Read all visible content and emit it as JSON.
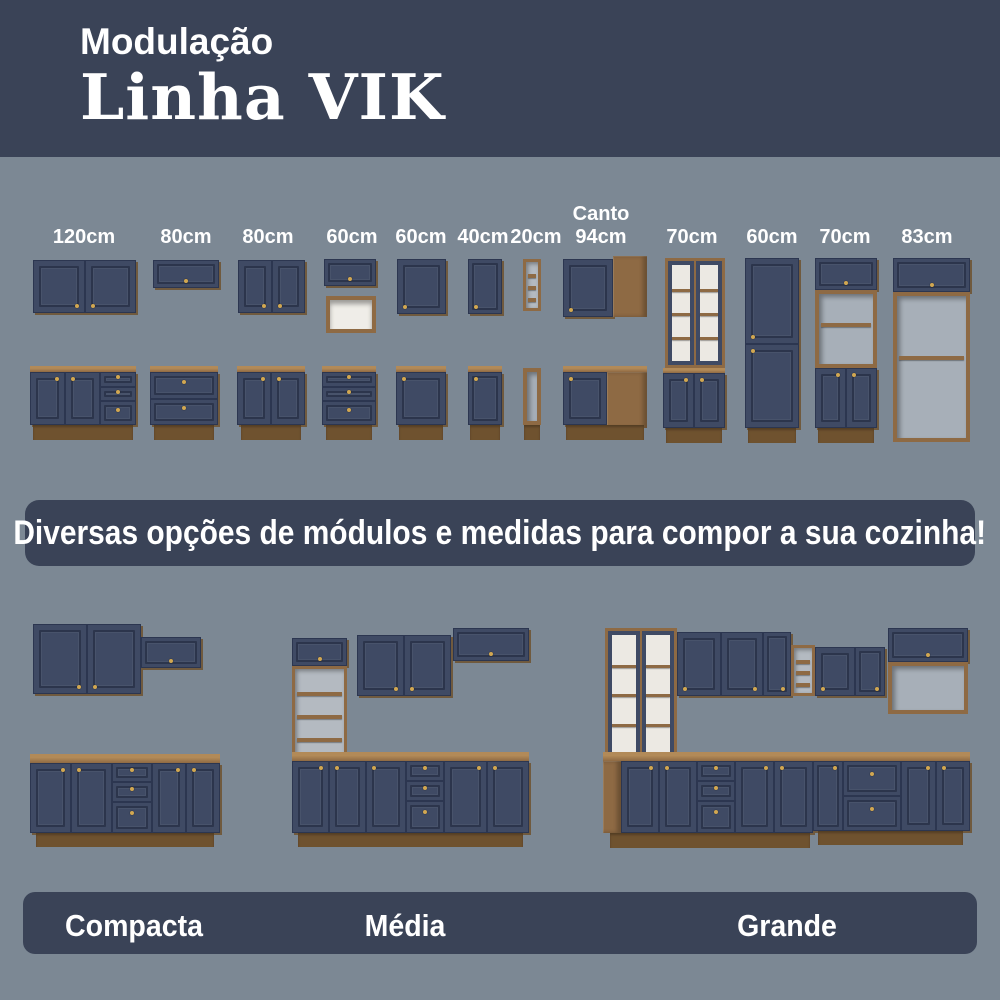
{
  "palette": {
    "background": "#7C8894",
    "panel_navy": "#3A4357",
    "cabinet_navy": "#3F4A64",
    "cabinet_navy_edge": "#2C3650",
    "wood": "#8E6A44",
    "wood_dark": "#6F522F",
    "knob_gold": "#D2A852",
    "text_white": "#FFFFFF"
  },
  "header": {
    "kicker": "Modulação",
    "title": "Linha VIK"
  },
  "banner": {
    "text": "Diversas opções de módulos e medidas para compor a sua cozinha!"
  },
  "modules": {
    "items": [
      {
        "name": "module-120cm",
        "label": "120cm",
        "lx": 84,
        "pieces": [
          {
            "t": "doors2",
            "x": 33,
            "y": 260,
            "w": 103,
            "h": 53,
            "k": "b"
          },
          {
            "t": "counter",
            "x": 30,
            "y": 366,
            "w": 106,
            "h": 6
          },
          {
            "t": "doors2",
            "x": 30,
            "y": 372,
            "w": 70,
            "h": 53,
            "k": "t"
          },
          {
            "t": "drawers3",
            "x": 100,
            "y": 372,
            "w": 36,
            "h": 53
          },
          {
            "t": "plinth",
            "x": 33,
            "y": 425,
            "w": 100,
            "h": 15
          }
        ]
      },
      {
        "name": "module-80cm-a",
        "label": "80cm",
        "lx": 186,
        "pieces": [
          {
            "t": "hdoor",
            "x": 153,
            "y": 260,
            "w": 66,
            "h": 28
          },
          {
            "t": "counter",
            "x": 150,
            "y": 366,
            "w": 68,
            "h": 6
          },
          {
            "t": "drawers2",
            "x": 150,
            "y": 372,
            "w": 68,
            "h": 53
          },
          {
            "t": "plinth",
            "x": 154,
            "y": 425,
            "w": 60,
            "h": 15
          }
        ]
      },
      {
        "name": "module-80cm-b",
        "label": "80cm",
        "lx": 268,
        "pieces": [
          {
            "t": "doors2",
            "x": 238,
            "y": 260,
            "w": 67,
            "h": 53,
            "k": "b"
          },
          {
            "t": "counter",
            "x": 237,
            "y": 366,
            "w": 68,
            "h": 6
          },
          {
            "t": "doors2",
            "x": 237,
            "y": 372,
            "w": 68,
            "h": 53,
            "k": "t"
          },
          {
            "t": "plinth",
            "x": 241,
            "y": 425,
            "w": 60,
            "h": 15
          }
        ]
      },
      {
        "name": "module-60cm-a",
        "label": "60cm",
        "lx": 352,
        "pieces": [
          {
            "t": "hdoor",
            "x": 324,
            "y": 259,
            "w": 52,
            "h": 27
          },
          {
            "t": "niche",
            "x": 326,
            "y": 296,
            "w": 50,
            "h": 37
          },
          {
            "t": "counter",
            "x": 322,
            "y": 366,
            "w": 54,
            "h": 6
          },
          {
            "t": "drawers3",
            "x": 322,
            "y": 372,
            "w": 54,
            "h": 53
          },
          {
            "t": "plinth",
            "x": 326,
            "y": 425,
            "w": 46,
            "h": 15
          }
        ]
      },
      {
        "name": "module-60cm-b",
        "label": "60cm",
        "lx": 421,
        "pieces": [
          {
            "t": "door",
            "x": 397,
            "y": 259,
            "w": 49,
            "h": 55,
            "k": "bl"
          },
          {
            "t": "counter",
            "x": 396,
            "y": 366,
            "w": 50,
            "h": 6
          },
          {
            "t": "door",
            "x": 396,
            "y": 372,
            "w": 50,
            "h": 53,
            "k": "tl"
          },
          {
            "t": "plinth",
            "x": 399,
            "y": 425,
            "w": 44,
            "h": 15
          }
        ]
      },
      {
        "name": "module-40cm",
        "label": "40cm",
        "lx": 483,
        "pieces": [
          {
            "t": "door",
            "x": 468,
            "y": 259,
            "w": 34,
            "h": 55,
            "k": "bl"
          },
          {
            "t": "counter",
            "x": 468,
            "y": 366,
            "w": 34,
            "h": 6
          },
          {
            "t": "door",
            "x": 468,
            "y": 372,
            "w": 34,
            "h": 53,
            "k": "tl"
          },
          {
            "t": "plinth",
            "x": 470,
            "y": 425,
            "w": 30,
            "h": 15
          }
        ]
      },
      {
        "name": "module-20cm",
        "label": "20cm",
        "lx": 536,
        "pieces": [
          {
            "t": "shelves",
            "x": 523,
            "y": 259,
            "w": 18,
            "h": 52
          },
          {
            "t": "open",
            "x": 523,
            "y": 368,
            "w": 18,
            "h": 57
          },
          {
            "t": "plinth",
            "x": 524,
            "y": 425,
            "w": 16,
            "h": 15
          }
        ]
      },
      {
        "name": "module-canto-94cm",
        "label": "Canto\n94cm",
        "lx": 601,
        "pieces": [
          {
            "t": "door",
            "x": 563,
            "y": 259,
            "w": 50,
            "h": 58,
            "k": "bl"
          },
          {
            "t": "wood",
            "x": 613,
            "y": 256,
            "w": 34,
            "h": 61
          },
          {
            "t": "counter",
            "x": 563,
            "y": 366,
            "w": 84,
            "h": 6
          },
          {
            "t": "door",
            "x": 563,
            "y": 372,
            "w": 44,
            "h": 53,
            "k": "tl"
          },
          {
            "t": "wood",
            "x": 607,
            "y": 372,
            "w": 40,
            "h": 56
          },
          {
            "t": "plinth",
            "x": 566,
            "y": 425,
            "w": 78,
            "h": 15
          }
        ]
      },
      {
        "name": "module-70cm-cristaleira",
        "label": "70cm",
        "lx": 692,
        "pieces": [
          {
            "t": "glass2",
            "x": 665,
            "y": 258,
            "w": 60,
            "h": 110
          },
          {
            "t": "counter",
            "x": 663,
            "y": 368,
            "w": 62,
            "h": 5
          },
          {
            "t": "doors2",
            "x": 663,
            "y": 373,
            "w": 62,
            "h": 55,
            "k": "t"
          },
          {
            "t": "plinth",
            "x": 666,
            "y": 428,
            "w": 56,
            "h": 15
          }
        ]
      },
      {
        "name": "module-60cm-paneleiro",
        "label": "60cm",
        "lx": 772,
        "pieces": [
          {
            "t": "door",
            "x": 745,
            "y": 258,
            "w": 54,
            "h": 86,
            "k": "bl"
          },
          {
            "t": "door",
            "x": 745,
            "y": 344,
            "w": 54,
            "h": 84,
            "k": "tl"
          },
          {
            "t": "plinth",
            "x": 748,
            "y": 428,
            "w": 48,
            "h": 15
          }
        ]
      },
      {
        "name": "module-70cm-torre",
        "label": "70cm",
        "lx": 845,
        "pieces": [
          {
            "t": "hdoor",
            "x": 815,
            "y": 258,
            "w": 62,
            "h": 32
          },
          {
            "t": "open",
            "x": 815,
            "y": 290,
            "w": 62,
            "h": 78
          },
          {
            "t": "doors2",
            "x": 815,
            "y": 368,
            "w": 62,
            "h": 60,
            "k": "t"
          },
          {
            "t": "plinth",
            "x": 818,
            "y": 428,
            "w": 56,
            "h": 15
          }
        ]
      },
      {
        "name": "module-83cm",
        "label": "83cm",
        "lx": 927,
        "pieces": [
          {
            "t": "hdoor",
            "x": 893,
            "y": 258,
            "w": 77,
            "h": 34
          },
          {
            "t": "open",
            "x": 893,
            "y": 292,
            "w": 77,
            "h": 150
          }
        ]
      }
    ]
  },
  "kitchens": {
    "items": [
      {
        "name": "compacta",
        "label": "Compacta",
        "pieces": [
          {
            "t": "doors2",
            "x": 33,
            "y": 624,
            "w": 108,
            "h": 70,
            "k": "b"
          },
          {
            "t": "hdoor",
            "x": 141,
            "y": 637,
            "w": 60,
            "h": 31
          },
          {
            "t": "counter",
            "x": 30,
            "y": 754,
            "w": 190,
            "h": 9
          },
          {
            "t": "doors2",
            "x": 30,
            "y": 763,
            "w": 82,
            "h": 70,
            "k": "t"
          },
          {
            "t": "drawers3",
            "x": 112,
            "y": 763,
            "w": 40,
            "h": 70
          },
          {
            "t": "doors2",
            "x": 152,
            "y": 763,
            "w": 68,
            "h": 70,
            "k": "t"
          },
          {
            "t": "plinth",
            "x": 36,
            "y": 833,
            "w": 178,
            "h": 14
          }
        ]
      },
      {
        "name": "media",
        "label": "Média",
        "pieces": [
          {
            "t": "hdoor",
            "x": 292,
            "y": 638,
            "w": 55,
            "h": 28
          },
          {
            "t": "shelves",
            "x": 292,
            "y": 666,
            "w": 55,
            "h": 94
          },
          {
            "t": "doors2",
            "x": 357,
            "y": 635,
            "w": 94,
            "h": 61,
            "k": "b"
          },
          {
            "t": "hdoor",
            "x": 453,
            "y": 628,
            "w": 76,
            "h": 33
          },
          {
            "t": "counter",
            "x": 292,
            "y": 752,
            "w": 237,
            "h": 9
          },
          {
            "t": "doors2",
            "x": 292,
            "y": 761,
            "w": 74,
            "h": 72,
            "k": "t"
          },
          {
            "t": "door",
            "x": 366,
            "y": 761,
            "w": 40,
            "h": 72,
            "k": "tl"
          },
          {
            "t": "drawers3",
            "x": 406,
            "y": 761,
            "w": 38,
            "h": 72
          },
          {
            "t": "doors2",
            "x": 444,
            "y": 761,
            "w": 85,
            "h": 72,
            "k": "t"
          },
          {
            "t": "plinth",
            "x": 298,
            "y": 833,
            "w": 225,
            "h": 14
          }
        ]
      },
      {
        "name": "grande",
        "label": "Grande",
        "pieces": [
          {
            "t": "glass2",
            "x": 605,
            "y": 628,
            "w": 72,
            "h": 132
          },
          {
            "t": "door",
            "x": 677,
            "y": 632,
            "w": 44,
            "h": 64,
            "k": "bl"
          },
          {
            "t": "door",
            "x": 721,
            "y": 632,
            "w": 42,
            "h": 64,
            "k": "br"
          },
          {
            "t": "door",
            "x": 763,
            "y": 632,
            "w": 28,
            "h": 64,
            "k": "br"
          },
          {
            "t": "shelves",
            "x": 791,
            "y": 645,
            "w": 24,
            "h": 51
          },
          {
            "t": "door",
            "x": 815,
            "y": 647,
            "w": 40,
            "h": 49,
            "k": "bl"
          },
          {
            "t": "door",
            "x": 855,
            "y": 647,
            "w": 30,
            "h": 49,
            "k": "br"
          },
          {
            "t": "hdoor",
            "x": 888,
            "y": 628,
            "w": 80,
            "h": 34
          },
          {
            "t": "open",
            "x": 888,
            "y": 662,
            "w": 80,
            "h": 52
          },
          {
            "t": "counter",
            "x": 603,
            "y": 752,
            "w": 212,
            "h": 9
          },
          {
            "t": "counter",
            "x": 813,
            "y": 752,
            "w": 157,
            "h": 9
          },
          {
            "t": "wood",
            "x": 603,
            "y": 761,
            "w": 18,
            "h": 72
          },
          {
            "t": "doors2",
            "x": 621,
            "y": 761,
            "w": 76,
            "h": 72,
            "k": "t"
          },
          {
            "t": "drawers3",
            "x": 697,
            "y": 761,
            "w": 38,
            "h": 72
          },
          {
            "t": "doors2",
            "x": 735,
            "y": 761,
            "w": 78,
            "h": 72,
            "k": "t"
          },
          {
            "t": "door",
            "x": 813,
            "y": 761,
            "w": 30,
            "h": 70,
            "k": "tr"
          },
          {
            "t": "drawers2",
            "x": 843,
            "y": 761,
            "w": 58,
            "h": 70
          },
          {
            "t": "doors2",
            "x": 901,
            "y": 761,
            "w": 69,
            "h": 70,
            "k": "t"
          },
          {
            "t": "plinth",
            "x": 610,
            "y": 833,
            "w": 200,
            "h": 15
          },
          {
            "t": "plinth",
            "x": 818,
            "y": 831,
            "w": 145,
            "h": 14
          }
        ]
      }
    ]
  }
}
